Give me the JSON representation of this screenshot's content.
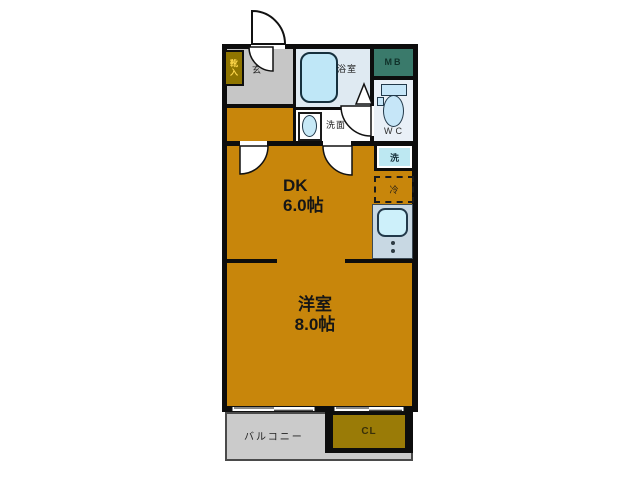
{
  "plan_type": "apartment-floor-plan",
  "labels": {
    "entrance": "玄",
    "shoe_box": "靴入",
    "bath": "浴室",
    "meter_box": "MB",
    "toilet": "WC",
    "washroom": "洗面",
    "washer": "洗",
    "fridge": "冷",
    "dk_name": "DK",
    "dk_size": "6.0帖",
    "western_name": "洋室",
    "western_size": "8.0帖",
    "balcony": "バルコニー",
    "closet": "CL"
  },
  "rooms": [
    {
      "name": "DK",
      "size_jo": 6.0
    },
    {
      "name": "洋室",
      "size_jo": 8.0
    }
  ],
  "colors": {
    "wall": "#0d0d0d",
    "tatami_floor": "#c8860b",
    "entrance_floor": "#c6c6c6",
    "bath_floor": "#dfeaf2",
    "fixture_fill": "#bfe7f7",
    "meter_box_fill": "#3a7a6b",
    "wc_floor": "#e9f0f7",
    "kitchen_counter": "#c8d8e3",
    "washer_fill": "#bde8f2",
    "balcony_floor": "#cbcbcb",
    "closet_fill": "#9a7b07",
    "shoe_box_fill": "#8f7500",
    "shoe_box_text": "#ffd84d"
  }
}
